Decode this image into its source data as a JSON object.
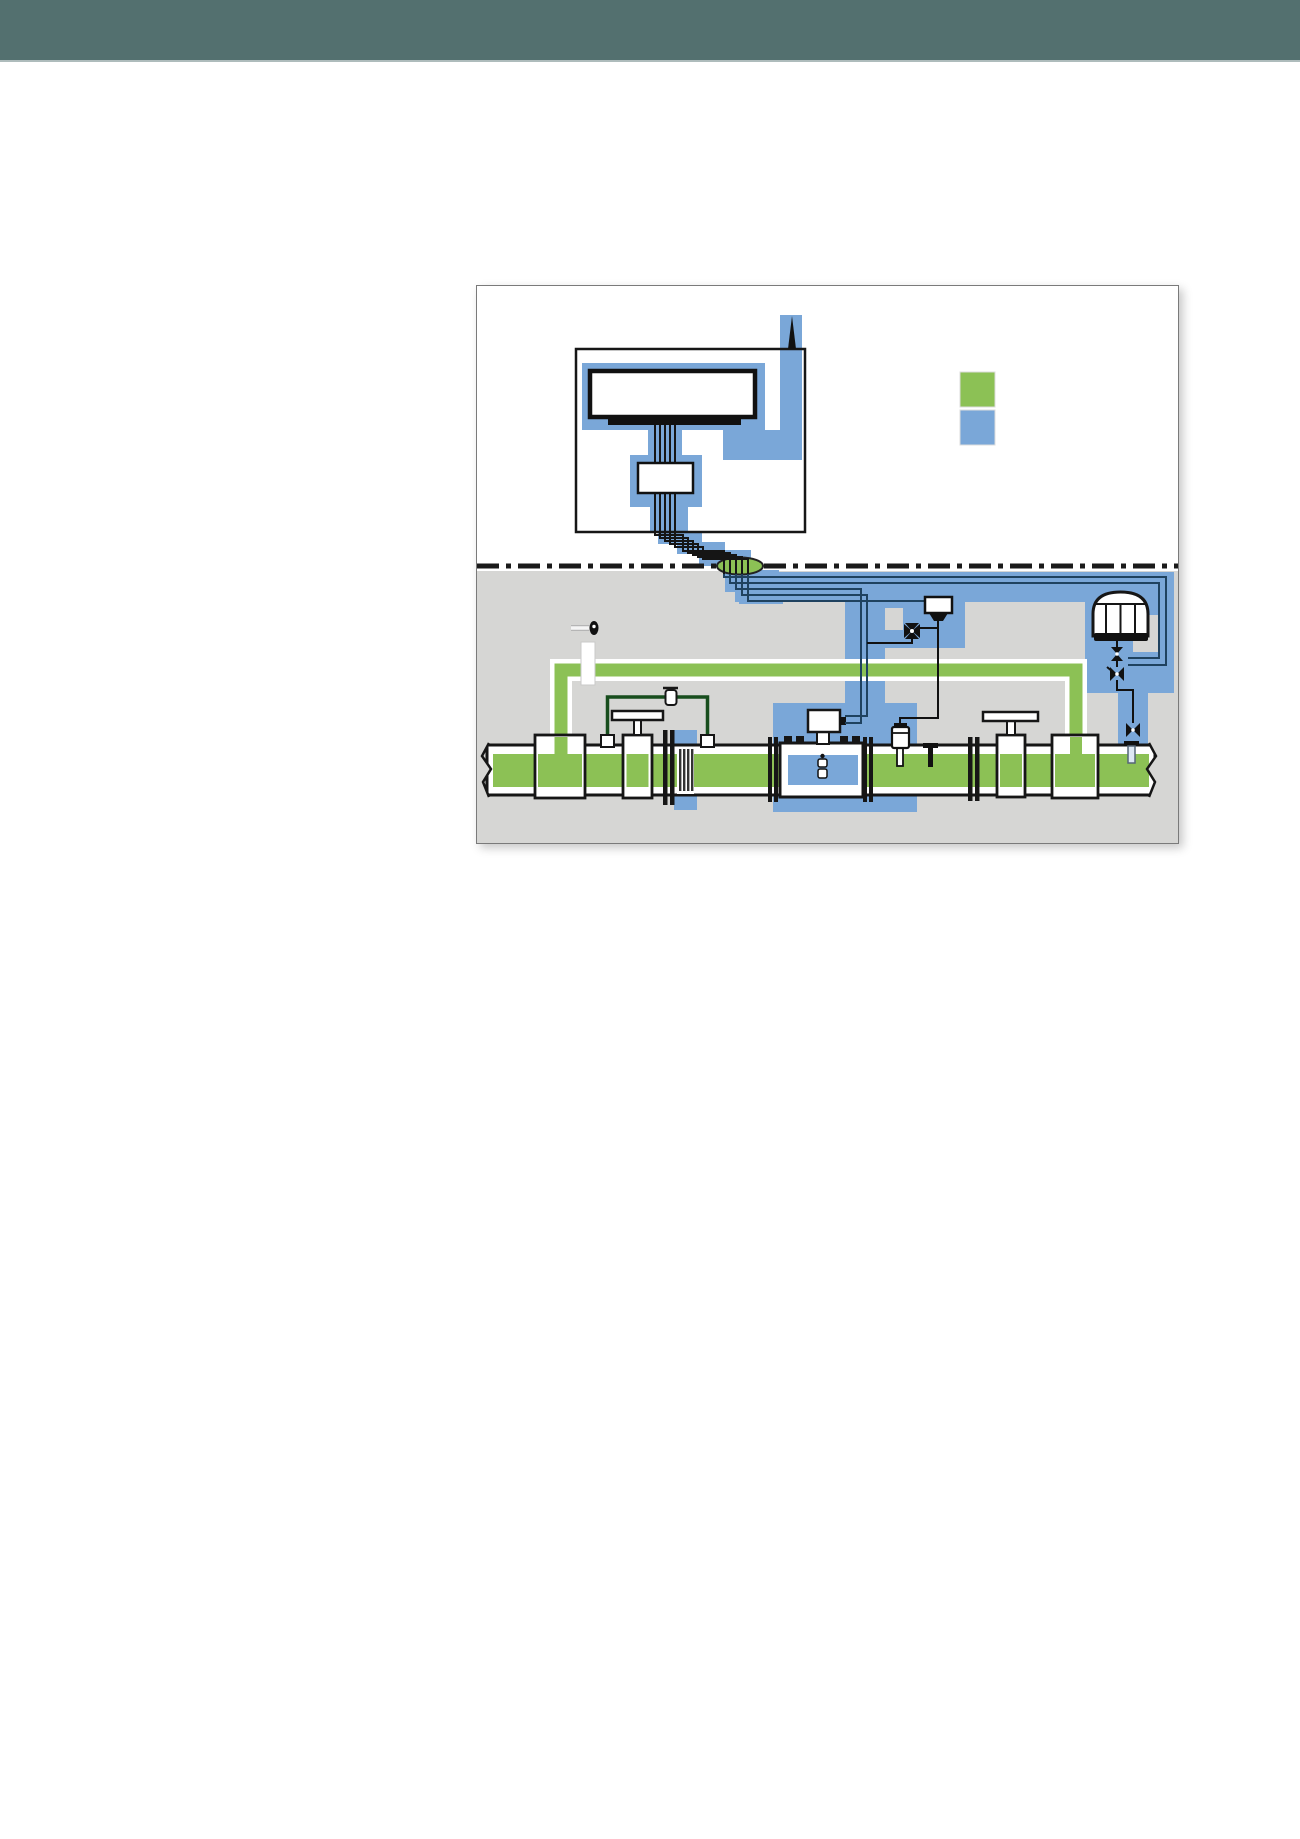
{
  "page": {
    "background": "#ffffff"
  },
  "header": {
    "color": "#53706f"
  },
  "diagram": {
    "frame_color": "#7a7a7a",
    "field_background": "#d6d6d4",
    "colors": {
      "green": "#8cc155",
      "blue": "#7aa7d8",
      "cable": "#1f425f",
      "loop_green": "#174d1d",
      "pipe_outline": "#161616"
    },
    "legend": {
      "swatches": [
        {
          "name": "green-swatch",
          "color": "#8cc155"
        },
        {
          "name": "blue-swatch",
          "color": "#7aa7d8"
        }
      ]
    },
    "icons": [
      "monitor-icon",
      "flow-computer-icon",
      "antenna-icon",
      "cable-gland-icon",
      "pipeline-icon",
      "gate-valve-icon",
      "flow-conditioner-icon",
      "ultrasonic-meter-icon",
      "signal-processing-unit-icon",
      "pressure-transmitter-icon",
      "thermowell-icon",
      "gas-chromatograph-icon",
      "sample-probe-icon",
      "needle-valve-icon",
      "filter-icon"
    ]
  }
}
